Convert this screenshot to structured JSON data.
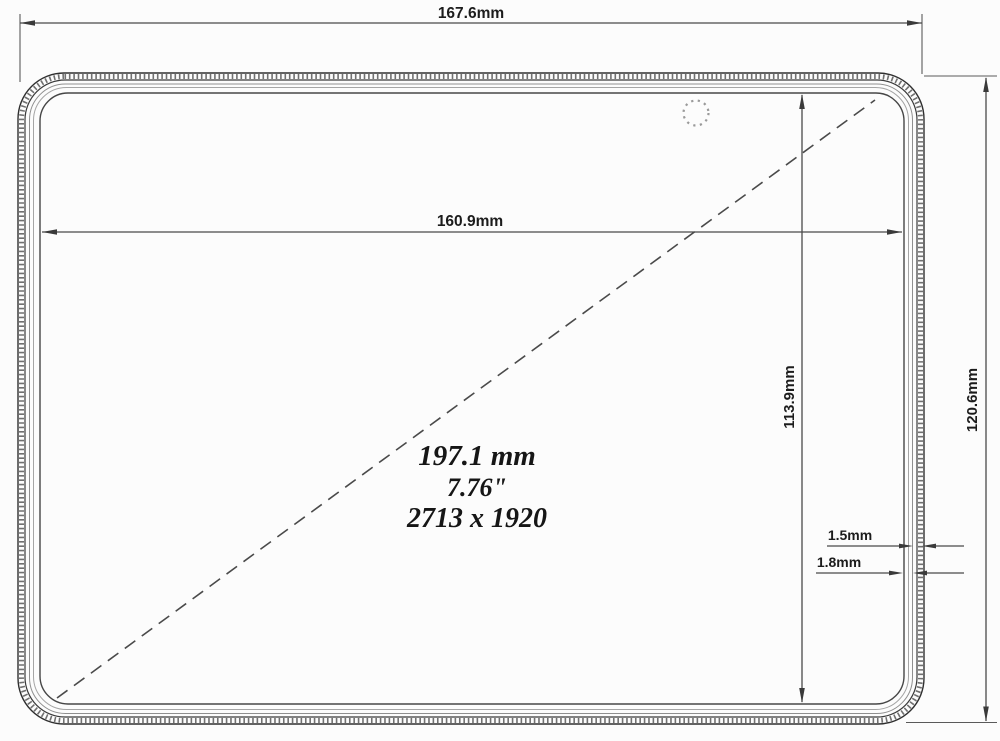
{
  "colors": {
    "background": "#fcfcfc",
    "outline": "#2f2f2f",
    "dimension_lines": "#4a4a4a",
    "label_text": "#1c1c1c",
    "edge_texture": "#707070"
  },
  "device": {
    "camera_icon": "camera-hole-dotted-circle"
  },
  "dimensions": {
    "overall_width": "167.6mm",
    "active_area_width": "160.9mm",
    "active_area_height": "113.9mm",
    "overall_height": "120.6mm",
    "bezel_gap_1": "1.5mm",
    "bezel_gap_2": "1.8mm"
  },
  "display_spec": {
    "diagonal_mm": "197.1 mm",
    "diagonal_inches": "7.76\"",
    "resolution": "2713 x 1920"
  }
}
